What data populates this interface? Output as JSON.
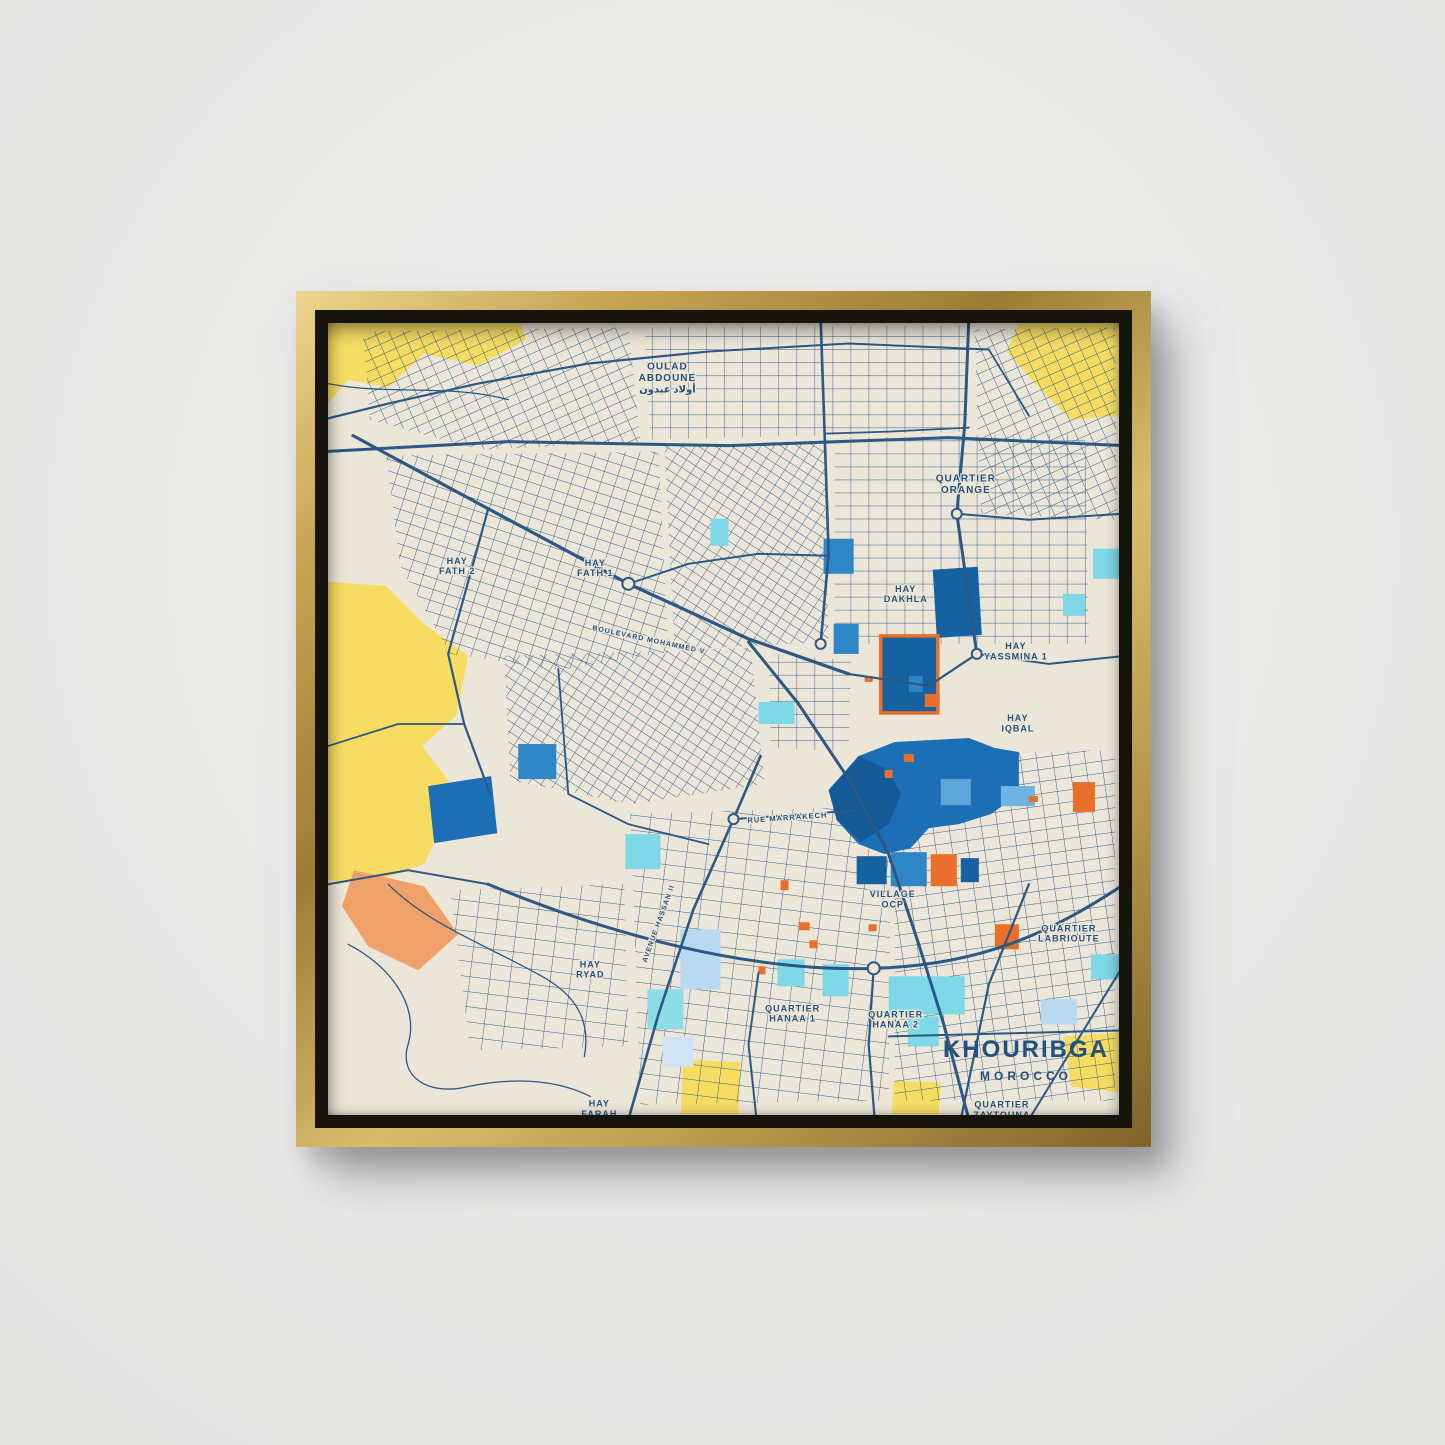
{
  "scene": {
    "wall_color": "#e9e9e8",
    "frame_style": "gold-floater",
    "frame_gold": "#c6a252",
    "frame_gap": "#17130d"
  },
  "poster": {
    "title": "KHOURIBGA",
    "subtitle": "MOROCCO",
    "title_color": "#24517c"
  },
  "map": {
    "palette": {
      "background": "#ece6d8",
      "road": "#2b5884",
      "yellow": "#f6dd62",
      "peach": "#f0a169",
      "blue": "#1d6fb5",
      "blue_dark": "#135a96",
      "cyan": "#7fd8e8",
      "pale_blue": "#b8d9f0",
      "orange": "#e8702a",
      "label": "#24517c"
    },
    "base_areas": [
      {
        "points": "0,0 192,0 198,16 150,42 96,30 60,64 20,56 0,80",
        "fill": "#f6dd62"
      },
      {
        "points": "690,0 790,0 790,92 742,96 706,60 678,28",
        "fill": "#f6dd62"
      },
      {
        "points": "0,258 58,262 96,300 140,332 128,392 94,422 130,470 96,540 40,560 0,556",
        "fill": "#f6dd62"
      },
      {
        "points": "355,735 412,738 410,790 352,790",
        "fill": "#f6dd62"
      },
      {
        "points": "565,756 612,758 610,790 563,790",
        "fill": "#f6dd62"
      },
      {
        "points": "735,712 790,708 790,768 742,762",
        "fill": "#f6dd62"
      },
      {
        "points": "26,546 96,562 130,610 90,646 40,622 14,582",
        "fill": "#f0a169"
      }
    ],
    "districts": [
      {
        "points": "35,8 300,4 312,118 152,126 42,96",
        "pattern": "g2"
      },
      {
        "points": "316,4 636,2 640,108 322,116",
        "pattern": "g0"
      },
      {
        "points": "646,6 786,4 788,196 652,190",
        "pattern": "g2"
      },
      {
        "points": "58,132 330,128 340,328 232,346 122,330 72,242",
        "pattern": "g1"
      },
      {
        "points": "336,122 496,118 500,318 346,326",
        "pattern": "g4"
      },
      {
        "points": "506,114 756,110 760,320 506,320",
        "pattern": "g0"
      },
      {
        "points": "176,332 422,324 436,460 302,480 182,456",
        "pattern": "g4"
      },
      {
        "points": "440,330 522,336 520,428 442,424",
        "pattern": "g0"
      },
      {
        "points": "302,490 562,482 560,776 312,780",
        "pattern": "g3"
      },
      {
        "points": "566,432 786,426 786,776 566,776",
        "pattern": "g5"
      },
      {
        "points": "122,566 296,560 300,722 142,726",
        "pattern": "g3"
      }
    ],
    "patches": [
      {
        "shape": "polygon",
        "points": "100,462 163,452 169,509 106,519",
        "fill": "#1d6fb5"
      },
      {
        "shape": "polygon",
        "points": "604,246 649,243 653,311 608,314",
        "fill": "#16619f"
      },
      {
        "shape": "rect",
        "x": 552,
        "y": 312,
        "w": 57,
        "h": 77,
        "fill": "#16619f",
        "stroke": "#e8702a",
        "sw": 3.5
      },
      {
        "shape": "polygon",
        "points": "500,466 530,432 566,418 640,414 666,424 690,428 690,470 662,490 630,500 600,504 582,524 556,530 530,520 508,496",
        "fill": "#1d6fb5"
      },
      {
        "shape": "polygon",
        "points": "500,466 530,432 560,446 572,470 560,500 532,518 508,495",
        "fill": "#135a96"
      },
      {
        "shape": "rect",
        "x": 528,
        "y": 532,
        "w": 30,
        "h": 28,
        "fill": "#16619f"
      },
      {
        "shape": "rect",
        "x": 562,
        "y": 528,
        "w": 36,
        "h": 34,
        "fill": "#2f86c7"
      },
      {
        "shape": "rect",
        "x": 602,
        "y": 530,
        "w": 26,
        "h": 32,
        "fill": "#e8702a"
      },
      {
        "shape": "rect",
        "x": 632,
        "y": 534,
        "w": 18,
        "h": 24,
        "fill": "#16619f"
      },
      {
        "shape": "rect",
        "x": 495,
        "y": 215,
        "w": 30,
        "h": 35,
        "fill": "#2f86c7"
      },
      {
        "shape": "rect",
        "x": 505,
        "y": 300,
        "w": 25,
        "h": 30,
        "fill": "#2f86c7"
      },
      {
        "shape": "rect",
        "x": 580,
        "y": 352,
        "w": 14,
        "h": 16,
        "fill": "#2f86c7"
      },
      {
        "shape": "rect",
        "x": 596,
        "y": 370,
        "w": 15,
        "h": 13,
        "fill": "#e8702a"
      },
      {
        "shape": "rect",
        "x": 612,
        "y": 455,
        "w": 30,
        "h": 26,
        "fill": "#5aa7d8"
      },
      {
        "shape": "rect",
        "x": 190,
        "y": 420,
        "w": 38,
        "h": 35,
        "fill": "#2f86c7"
      },
      {
        "shape": "rect",
        "x": 382,
        "y": 195,
        "w": 18,
        "h": 27,
        "fill": "#7fd8e8"
      },
      {
        "shape": "rect",
        "x": 430,
        "y": 378,
        "w": 36,
        "h": 22,
        "fill": "#7fd8e8"
      },
      {
        "shape": "rect",
        "x": 297,
        "y": 510,
        "w": 35,
        "h": 35,
        "fill": "#7fd8e8"
      },
      {
        "shape": "rect",
        "x": 352,
        "y": 605,
        "w": 40,
        "h": 60,
        "fill": "#b8d9f0"
      },
      {
        "shape": "rect",
        "x": 449,
        "y": 635,
        "w": 27,
        "h": 27,
        "fill": "#7fd8e8"
      },
      {
        "shape": "rect",
        "x": 494,
        "y": 640,
        "w": 26,
        "h": 32,
        "fill": "#7fd8e8"
      },
      {
        "shape": "rect",
        "x": 319,
        "y": 665,
        "w": 36,
        "h": 40,
        "fill": "#8edce6"
      },
      {
        "shape": "rect",
        "x": 334,
        "y": 712,
        "w": 31,
        "h": 30,
        "fill": "#cfe3f5"
      },
      {
        "shape": "rect",
        "x": 560,
        "y": 652,
        "w": 76,
        "h": 38,
        "fill": "#7fd8e8"
      },
      {
        "shape": "rect",
        "x": 579,
        "y": 692,
        "w": 31,
        "h": 30,
        "fill": "#7fd8e8"
      },
      {
        "shape": "rect",
        "x": 764,
        "y": 225,
        "w": 26,
        "h": 30,
        "fill": "#7fd8e8"
      },
      {
        "shape": "rect",
        "x": 734,
        "y": 270,
        "w": 22,
        "h": 22,
        "fill": "#7fd8e8"
      },
      {
        "shape": "rect",
        "x": 672,
        "y": 462,
        "w": 34,
        "h": 20,
        "fill": "#6fb3e0"
      },
      {
        "shape": "rect",
        "x": 744,
        "y": 458,
        "w": 22,
        "h": 30,
        "fill": "#e8702a"
      },
      {
        "shape": "rect",
        "x": 666,
        "y": 600,
        "w": 24,
        "h": 25,
        "fill": "#e8702a"
      },
      {
        "shape": "rect",
        "x": 762,
        "y": 630,
        "w": 28,
        "h": 25,
        "fill": "#7fd8e8"
      },
      {
        "shape": "rect",
        "x": 712,
        "y": 675,
        "w": 36,
        "h": 25,
        "fill": "#b8d9f0"
      },
      {
        "shape": "rect",
        "x": 575,
        "y": 430,
        "w": 10,
        "h": 8,
        "fill": "#e8702a"
      },
      {
        "shape": "rect",
        "x": 556,
        "y": 446,
        "w": 8,
        "h": 8,
        "fill": "#e8702a"
      },
      {
        "shape": "rect",
        "x": 452,
        "y": 556,
        "w": 8,
        "h": 10,
        "fill": "#e8702a"
      },
      {
        "shape": "rect",
        "x": 470,
        "y": 598,
        "w": 11,
        "h": 8,
        "fill": "#e8702a"
      },
      {
        "shape": "rect",
        "x": 481,
        "y": 616,
        "w": 8,
        "h": 8,
        "fill": "#e8702a"
      },
      {
        "shape": "rect",
        "x": 536,
        "y": 352,
        "w": 8,
        "h": 6,
        "fill": "#e8702a"
      },
      {
        "shape": "rect",
        "x": 540,
        "y": 600,
        "w": 8,
        "h": 7,
        "fill": "#e8702a"
      },
      {
        "shape": "rect",
        "x": 700,
        "y": 472,
        "w": 9,
        "h": 6,
        "fill": "#e8702a"
      },
      {
        "shape": "rect",
        "x": 430,
        "y": 642,
        "w": 7,
        "h": 8,
        "fill": "#e8702a"
      },
      {
        "shape": "rect",
        "x": 612,
        "y": 540,
        "w": 7,
        "h": 6,
        "fill": "#e8702a"
      }
    ],
    "roads": [
      {
        "d": "M -5,128 L 180,118 L 400,122 L 620,114 L 795,122",
        "w": 3
      },
      {
        "d": "M 25,112 L 160,185 L 300,260 L 420,315 L 520,350",
        "w": 3.2
      },
      {
        "d": "M 640,-5 L 636,100 L 628,190 L 638,260 L 648,330",
        "w": 3
      },
      {
        "d": "M 492,-5 L 496,110 L 500,230 L 492,320",
        "w": 2.6
      },
      {
        "d": "M -5,96 L 60,80 L 150,60 L 260,40 L 380,28",
        "w": 2.2
      },
      {
        "d": "M 380,28 L 520,20 L 660,26",
        "w": 2
      },
      {
        "d": "M 420,318 L 470,380 L 520,455 L 560,530 L 590,620 L 615,700 L 640,795",
        "w": 3
      },
      {
        "d": "M 160,560 C 280,610 420,648 545,644 C 650,641 720,610 795,560",
        "w": 3
      },
      {
        "d": "M 300,795 L 330,690 L 365,585 L 405,495 L 432,432",
        "w": 2.6
      },
      {
        "d": "M 405,495 L 530,486",
        "w": 2
      },
      {
        "d": "M 0,560 L 80,546 L 160,560",
        "w": 2
      },
      {
        "d": "M 628,190 L 700,196 L 795,190",
        "w": 2
      },
      {
        "d": "M 648,330 L 720,340 L 795,332",
        "w": 2
      },
      {
        "d": "M 496,110 L 560,108 L 640,104",
        "w": 1.8
      },
      {
        "d": "M 300,260 L 360,240 L 430,230 L 500,232",
        "w": 2
      },
      {
        "d": "M 160,185 L 140,258 L 120,330 L 136,400 L 162,470",
        "w": 2.2
      },
      {
        "d": "M 0,422 L 70,400 L 136,400",
        "w": 1.8
      },
      {
        "d": "M 520,350 L 600,362 L 648,330",
        "w": 2.2
      },
      {
        "d": "M 545,644 L 540,720 L 546,795",
        "w": 2.2
      },
      {
        "d": "M 430,648 L 420,720 L 428,795",
        "w": 2
      },
      {
        "d": "M 240,470 L 300,500 L 380,520",
        "w": 1.8
      },
      {
        "d": "M 20,620 C 60,640 92,680 80,720 C 70,752 100,772 140,762",
        "w": 1.3
      },
      {
        "d": "M 60,560 C 100,600 160,622 210,650 C 252,672 262,700 256,732",
        "w": 1.3
      },
      {
        "d": "M 140,762 C 190,752 230,756 262,772",
        "w": 1.3
      },
      {
        "d": "M 0,60 C 60,72 120,60 180,76",
        "w": 1.3
      },
      {
        "d": "M 560,712 L 795,706",
        "w": 2
      },
      {
        "d": "M 700,560 L 660,660 L 632,795",
        "w": 2.2
      },
      {
        "d": "M 795,640 L 700,795",
        "w": 2
      },
      {
        "d": "M 230,345 L 240,470",
        "w": 1.8
      },
      {
        "d": "M 660,26 L 700,92",
        "w": 1.8
      }
    ],
    "roundabouts": [
      {
        "cx": 300,
        "cy": 260,
        "r": 6
      },
      {
        "cx": 405,
        "cy": 495,
        "r": 5
      },
      {
        "cx": 545,
        "cy": 644,
        "r": 6
      },
      {
        "cx": 628,
        "cy": 190,
        "r": 5
      },
      {
        "cx": 648,
        "cy": 330,
        "r": 5
      },
      {
        "cx": 492,
        "cy": 320,
        "r": 5
      }
    ],
    "labels": [
      {
        "lines": [
          "OULAD",
          "ABDOUNE",
          "أولاد عبدون"
        ],
        "x": 339,
        "y": 46,
        "size": 10
      },
      {
        "lines": [
          "QUARTIER",
          "ORANGE"
        ],
        "x": 637,
        "y": 158,
        "size": 10
      },
      {
        "lines": [
          "HAY",
          "FATH 2"
        ],
        "x": 129,
        "y": 240,
        "size": 9
      },
      {
        "lines": [
          "HAY",
          "FATH 1"
        ],
        "x": 267,
        "y": 242,
        "size": 9
      },
      {
        "lines": [
          "HAY",
          "DAKHLA"
        ],
        "x": 577,
        "y": 268,
        "size": 9
      },
      {
        "lines": [
          "HAY",
          "YASSMINA 1"
        ],
        "x": 687,
        "y": 325,
        "size": 9
      },
      {
        "lines": [
          "HAY",
          "IQBAL"
        ],
        "x": 689,
        "y": 397,
        "size": 9
      },
      {
        "lines": [
          "RUE MARRAKECH"
        ],
        "x": 459,
        "y": 496,
        "size": 7.5,
        "rotate": -4
      },
      {
        "lines": [
          "VILLAGE",
          "OCP"
        ],
        "x": 564,
        "y": 573,
        "size": 9
      },
      {
        "lines": [
          "QUARTIER",
          "LABRIOUTE"
        ],
        "x": 740,
        "y": 607,
        "size": 9
      },
      {
        "lines": [
          "HAY",
          "RYAD"
        ],
        "x": 262,
        "y": 643,
        "size": 9
      },
      {
        "lines": [
          "QUARTIER",
          "HANAA 1"
        ],
        "x": 464,
        "y": 687,
        "size": 9
      },
      {
        "lines": [
          "QUARTIER",
          "HANAA 2"
        ],
        "x": 567,
        "y": 693,
        "size": 9
      },
      {
        "lines": [
          "HAY",
          "FARAH"
        ],
        "x": 271,
        "y": 782,
        "size": 9
      },
      {
        "lines": [
          "QUARTIER",
          "ZAYTOUNA"
        ],
        "x": 673,
        "y": 783,
        "size": 9
      },
      {
        "lines": [
          "BOULEVARD MOHAMMED V"
        ],
        "x": 320,
        "y": 318,
        "size": 7,
        "rotate": 12
      },
      {
        "lines": [
          "AVENUE HASSAN II"
        ],
        "x": 332,
        "y": 600,
        "size": 7,
        "rotate": -70
      }
    ]
  }
}
